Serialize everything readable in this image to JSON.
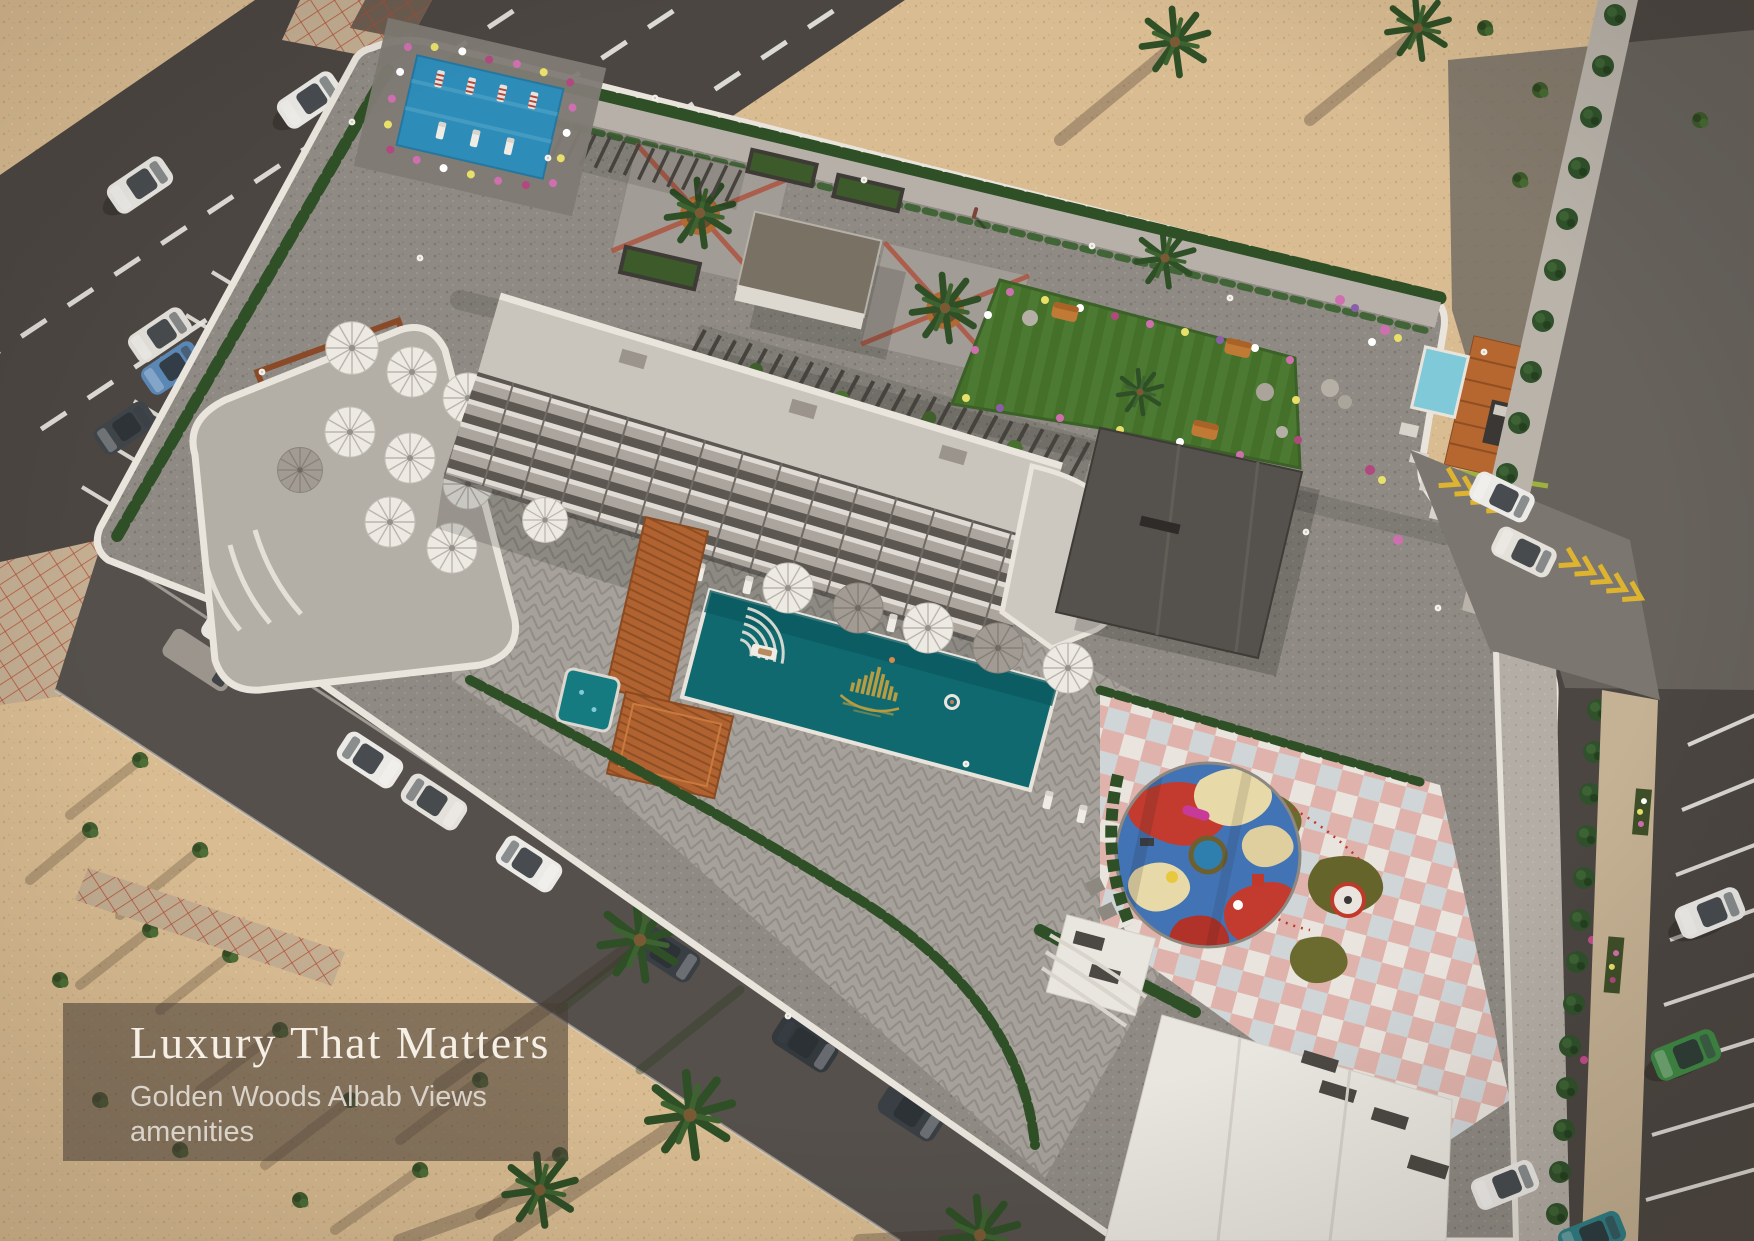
{
  "caption": {
    "title": "Luxury That Matters",
    "subtitle_line1": "Golden Woods Albab Views",
    "subtitle_line2": "amenities"
  },
  "watermark": {
    "icon": "golden-building-skyline-logo",
    "location": "pool-center"
  },
  "palette": {
    "sand": "#d9bc92",
    "asphalt": "#4c4642",
    "gravel": "#8f8b84",
    "paving": "#a6a19a",
    "walkway": "#b6b0a8",
    "pool_water": "#10696f",
    "kids_pool": "#2e8cb8",
    "spa_pool": "#7fc9d8",
    "lawn": "#4d7a32",
    "hedge": "#2f4f26",
    "wood_deck": "#b06330",
    "playground_blue": "#4273b5",
    "playground_red": "#c23b2e",
    "playground_cream": "#e8d9a8",
    "minigolf_olive": "#6b6b2f",
    "checker_pink": "#dfb3ab",
    "road_marking": "#eceae4",
    "yellow_marking": "#ddb32f",
    "red_grid_paving": "#b3543c",
    "overlay_bg": "rgba(73,62,53,0.58)",
    "title_color": "#f5efe6",
    "subtitle_color": "#dad3c9",
    "logo_gold": "#c9a23f"
  }
}
